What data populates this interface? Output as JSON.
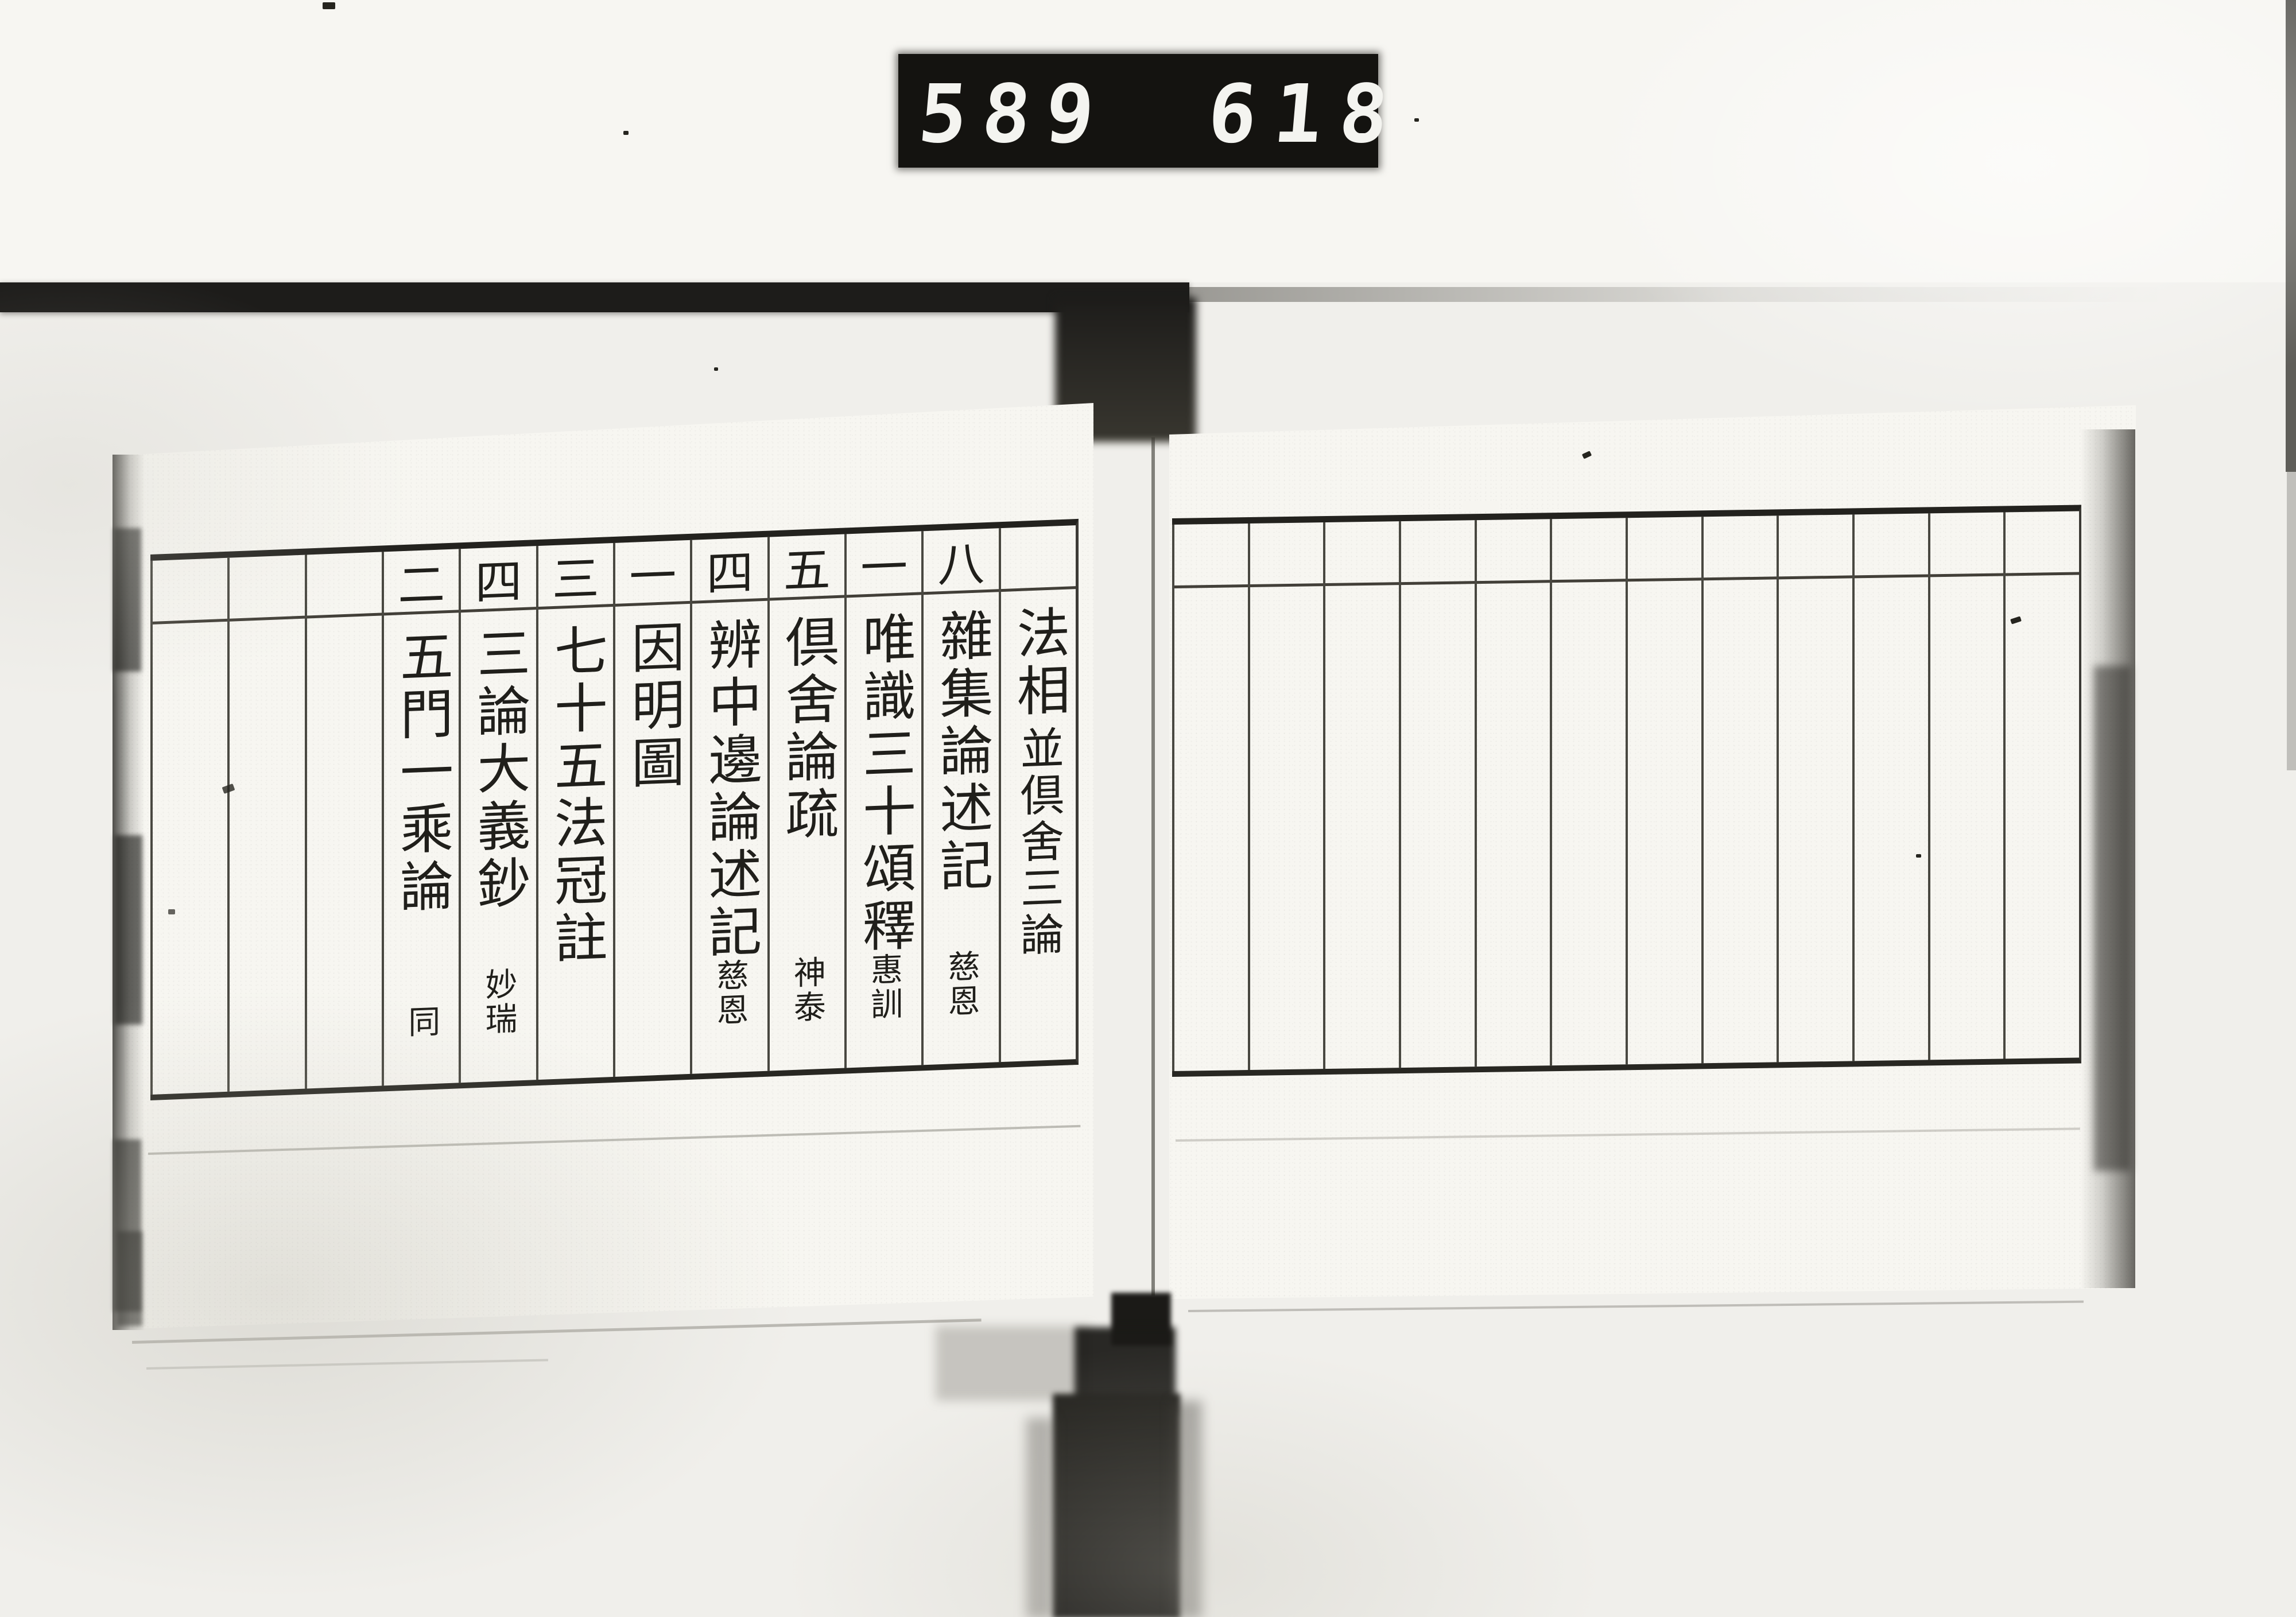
{
  "counter": {
    "left_value": "589",
    "right_value": "618"
  },
  "book": {
    "left_page": {
      "section_heading": "法相並倶舍三論",
      "columns": [
        {
          "number": "",
          "title": "法相",
          "subtitle": "並倶舍三論",
          "author": ""
        },
        {
          "number": "八",
          "title": "雜集論述記",
          "subtitle": "",
          "author": "慈恩"
        },
        {
          "number": "一",
          "title": "唯識三十頌釋",
          "subtitle": "",
          "author": "惠訓"
        },
        {
          "number": "五",
          "title": "倶舍論疏",
          "subtitle": "",
          "author": "神泰"
        },
        {
          "number": "四",
          "title": "辨中邊論述記",
          "subtitle": "",
          "author": "慈恩"
        },
        {
          "number": "一",
          "title": "因明圖",
          "subtitle": "",
          "author": ""
        },
        {
          "number": "三",
          "title": "七十五法冠註",
          "subtitle": "",
          "author": ""
        },
        {
          "number": "四",
          "title": "三論大義鈔",
          "subtitle": "",
          "author": "妙瑞"
        },
        {
          "number": "二",
          "title": "五門一乘論",
          "subtitle": "",
          "author": "同"
        },
        {
          "number": "",
          "title": "",
          "subtitle": "",
          "author": ""
        },
        {
          "number": "",
          "title": "",
          "subtitle": "",
          "author": ""
        },
        {
          "number": "",
          "title": "",
          "subtitle": "",
          "author": ""
        }
      ]
    },
    "right_page": {
      "column_count": 12
    }
  },
  "colors": {
    "paper": "#f7f6f1",
    "ink": "#201f1b",
    "band": "#1d1c1a",
    "counter_bg": "#141310",
    "digits": "#f4f4f0"
  }
}
